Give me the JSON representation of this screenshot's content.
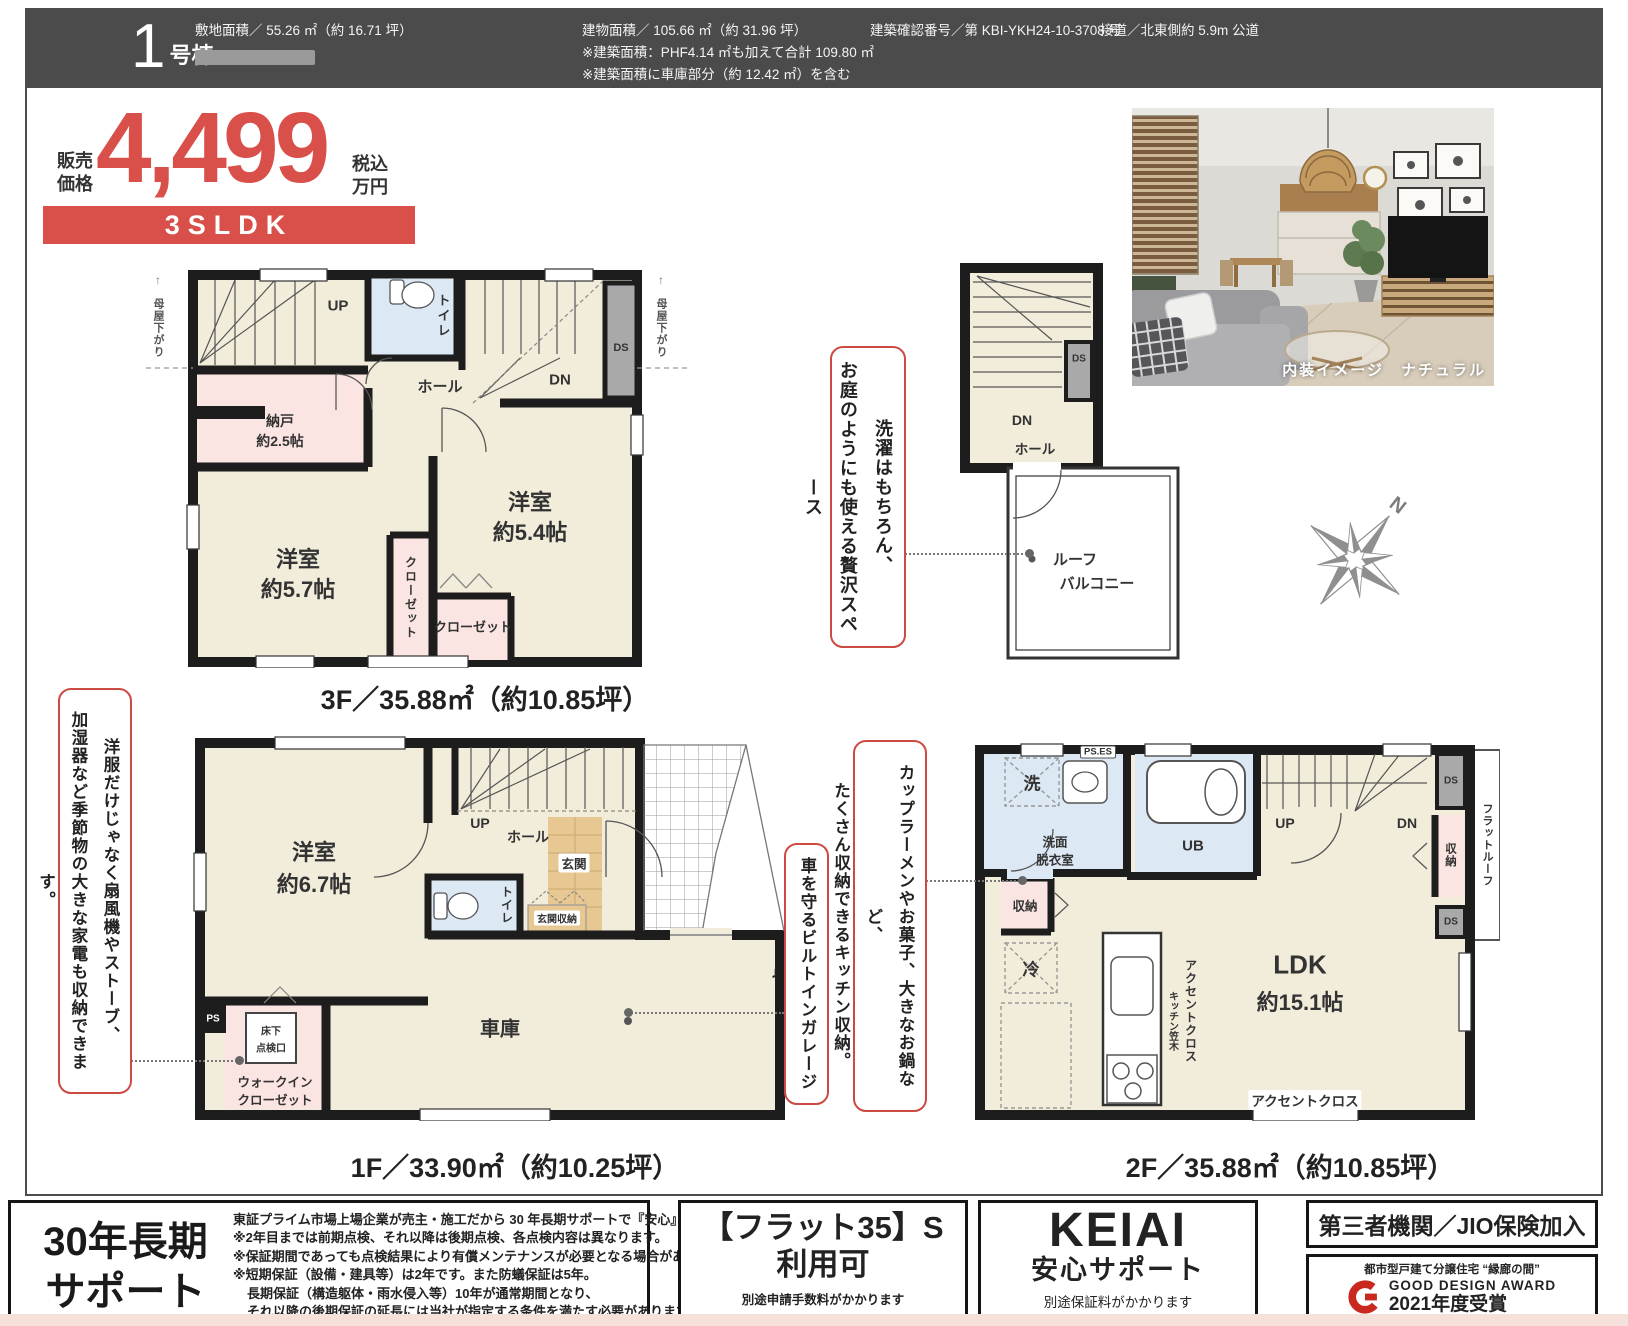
{
  "header": {
    "unit_no": "1",
    "unit_suffix": "号棟",
    "land_area": "敷地面積／ 55.26 ㎡（約 16.71 坪）",
    "building_area": "建物面積／ 105.66 ㎡（約 31.96 坪）",
    "building_note1": "※建築面積：PHF4.14 ㎡も加えて合計 109.80 ㎡",
    "building_note2": "※建築面積に車庫部分（約 12.42 ㎡）を含む",
    "confirmation_no": "建築確認番号／第 KBI-YKH24-10-3708 号",
    "road": "接道／北東側約 5.9m 公道"
  },
  "price": {
    "label_l1": "販売",
    "label_l2": "価格",
    "amount": "4,499",
    "tax_l1": "税込",
    "tax_l2": "万円",
    "plan_type": "3SLDK"
  },
  "photo": {
    "caption": "内装イメージ　ナチュラル"
  },
  "compass": {
    "north": "N"
  },
  "annotations": {
    "roof_col1": "洗濯はもちろん、",
    "roof_col2": "お庭のようにも使える贅沢スペース",
    "closet_col1": "洋服だけじゃなく扇風機やストーブ、",
    "closet_col2": "加湿器など季節物の大きな家電も収納できます。",
    "garage_text": "車を守るビルトインガレージ♪",
    "kitchen_col1": "カップラーメンやお菓子、大きなお鍋など、",
    "kitchen_col2": "たくさん収納できるキッチン収納。"
  },
  "plans": {
    "f3": {
      "caption": "3F／35.88㎡（約10.85坪）",
      "up": "UP",
      "dn": "DN",
      "ds": "DS",
      "toilet": "トイレ",
      "hall": "ホール",
      "storage_label": "納戸",
      "storage_size": "約2.5帖",
      "room1_label": "洋室",
      "room1_size": "約5.7帖",
      "room2_label": "洋室",
      "room2_size": "約5.4帖",
      "closet1": "クローゼット",
      "closet2": "クローゼット",
      "eaves_left": "母屋下がり",
      "eaves_right": "母屋下がり",
      "arrow_up": "↑"
    },
    "roof": {
      "dn": "DN",
      "ds": "DS",
      "hall": "ホール",
      "balcony_l1": "ルーフ",
      "balcony_l2": "バルコニー"
    },
    "f1": {
      "caption": "1F／33.90㎡（約10.25坪）",
      "room_label": "洋室",
      "room_size": "約6.7帖",
      "up": "UP",
      "hall": "ホール",
      "entry": "玄関",
      "entry_storage": "玄関収納",
      "toilet": "トイレ",
      "ps": "PS",
      "hatch_l1": "床下",
      "hatch_l2": "点検口",
      "wic_l1": "ウォークイン",
      "wic_l2": "クローゼット",
      "garage": "車庫"
    },
    "f2": {
      "caption": "2F／35.88㎡（約10.85坪）",
      "wash": "洗",
      "ps_es": "PS.ES",
      "sanitary_l1": "洗面",
      "sanitary_l2": "脱衣室",
      "ub": "UB",
      "up": "UP",
      "dn": "DN",
      "ds1": "DS",
      "ds2": "DS",
      "flat_roof": "フラットルーフ",
      "storage_right": "収納",
      "storage_left": "収納",
      "fridge": "冷",
      "kitchen_kasagi": "キッチン笠木",
      "accent_v": "アクセントクロス",
      "accent_h": "アクセントクロス",
      "ldk_label": "LDK",
      "ldk_size": "約15.1帖"
    }
  },
  "footer": {
    "support_title_l1": "30年長期",
    "support_title_l2": "サポート",
    "support_lines": [
      "東証プライム市場上場企業が売主・施工だから 30 年長期サポートで『安心』",
      "※2年目までは前期点検、それ以降は後期点検、各点検内容は異なります。",
      "※保証期間であっても点検結果により有償メンテナンスが必要となる場合があります。",
      "※短期保証（設備・建具等）は2年です。また防蟻保証は5年。",
      "長期保証（構造躯体・雨水侵入等）10年が通常期間となり、",
      "それ以降の後期保証の延長には当社が指定する条件を満たす必要があります。"
    ],
    "flat35_l1": "【フラット35】S",
    "flat35_l2": "利用可",
    "flat35_note": "別途申請手数料がかかります",
    "keiai_brand": "KEIAI",
    "keiai_sub": "安心サポート",
    "keiai_note": "別途保証料がかかります",
    "jio_label": "第三者機関／JIO保険加入",
    "gd_series": "都市型戸建て分譲住宅 “縁廊の間”",
    "gd_award": "GOOD DESIGN AWARD",
    "gd_year": "2021年度受賞"
  },
  "colors": {
    "accent_red": "#d9504a",
    "wall_black": "#1d1d1d",
    "room_cream": "#f2ecda",
    "room_pink": "#fbe5e2",
    "room_blue": "#dde8f5",
    "entry_tan": "#e7c892",
    "duct_gray": "#a9a9a9"
  }
}
